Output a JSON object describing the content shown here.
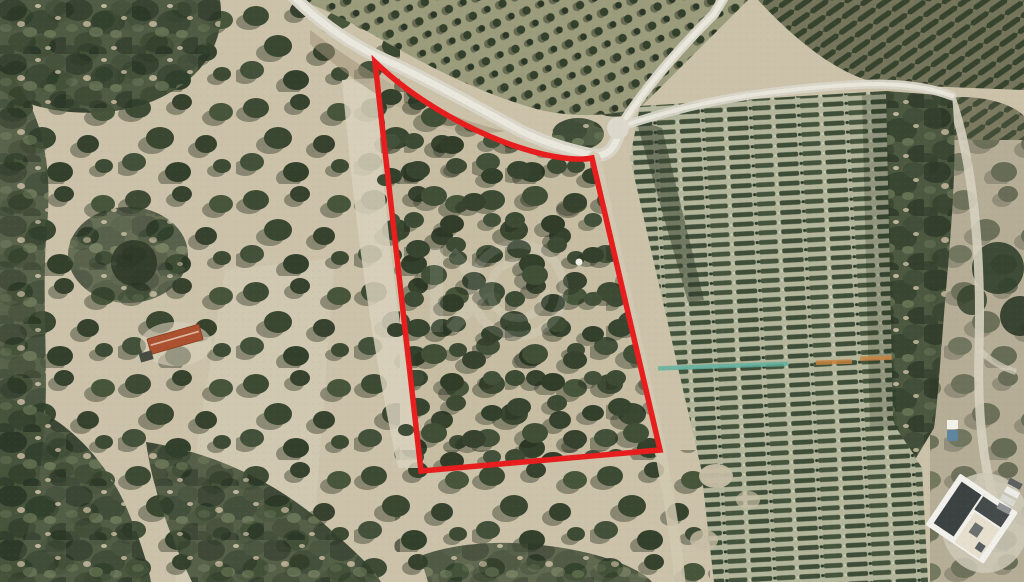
{
  "view": {
    "title": "aerial-land-plot-photo",
    "type": "satellite-imagery",
    "width": 1024,
    "height": 582
  },
  "plot_boundary": {
    "path": "M 375 62 C 412 98 468 131 521 148 C 552 158 578 161 592 158 L 660 450 L 421 471 Z",
    "color": "#e81e1e",
    "width": 5.5,
    "fill": "none"
  },
  "watermark": {
    "color": "#ffffff",
    "opacity": 0.11
  },
  "palette": {
    "soil_base": "#cbc2a9",
    "soil_light": "#d6ceb8",
    "dirt_band": "#d9d1bc",
    "orchard_base": "#9a9c7c",
    "vineyard_base": "#b2b498",
    "far_right_base": "#b6ad96",
    "road_fill": "#d8d5c8",
    "road_core": "#eae7dc",
    "side_path": "#d2c9b2",
    "teal_strip": "#5ab0a0",
    "orange_strip": "#c8833e",
    "house_roof": "#ab5130",
    "villa_body": "#f2f0ea",
    "villa_dark": "#3c4142",
    "pad_gray": "#cfc9b8"
  },
  "features": {
    "plot": "red-outlined land parcel with olive trees",
    "left_area": "olive grove with scrub patches",
    "right_area": "vineyard rows",
    "top_right_area": "diagonal vineyard block",
    "buildings": [
      "red-roof-house",
      "white-villa"
    ],
    "roads": [
      "main-curved-road",
      "upper-fork-road",
      "right-fork-road",
      "plot-side-track"
    ]
  }
}
